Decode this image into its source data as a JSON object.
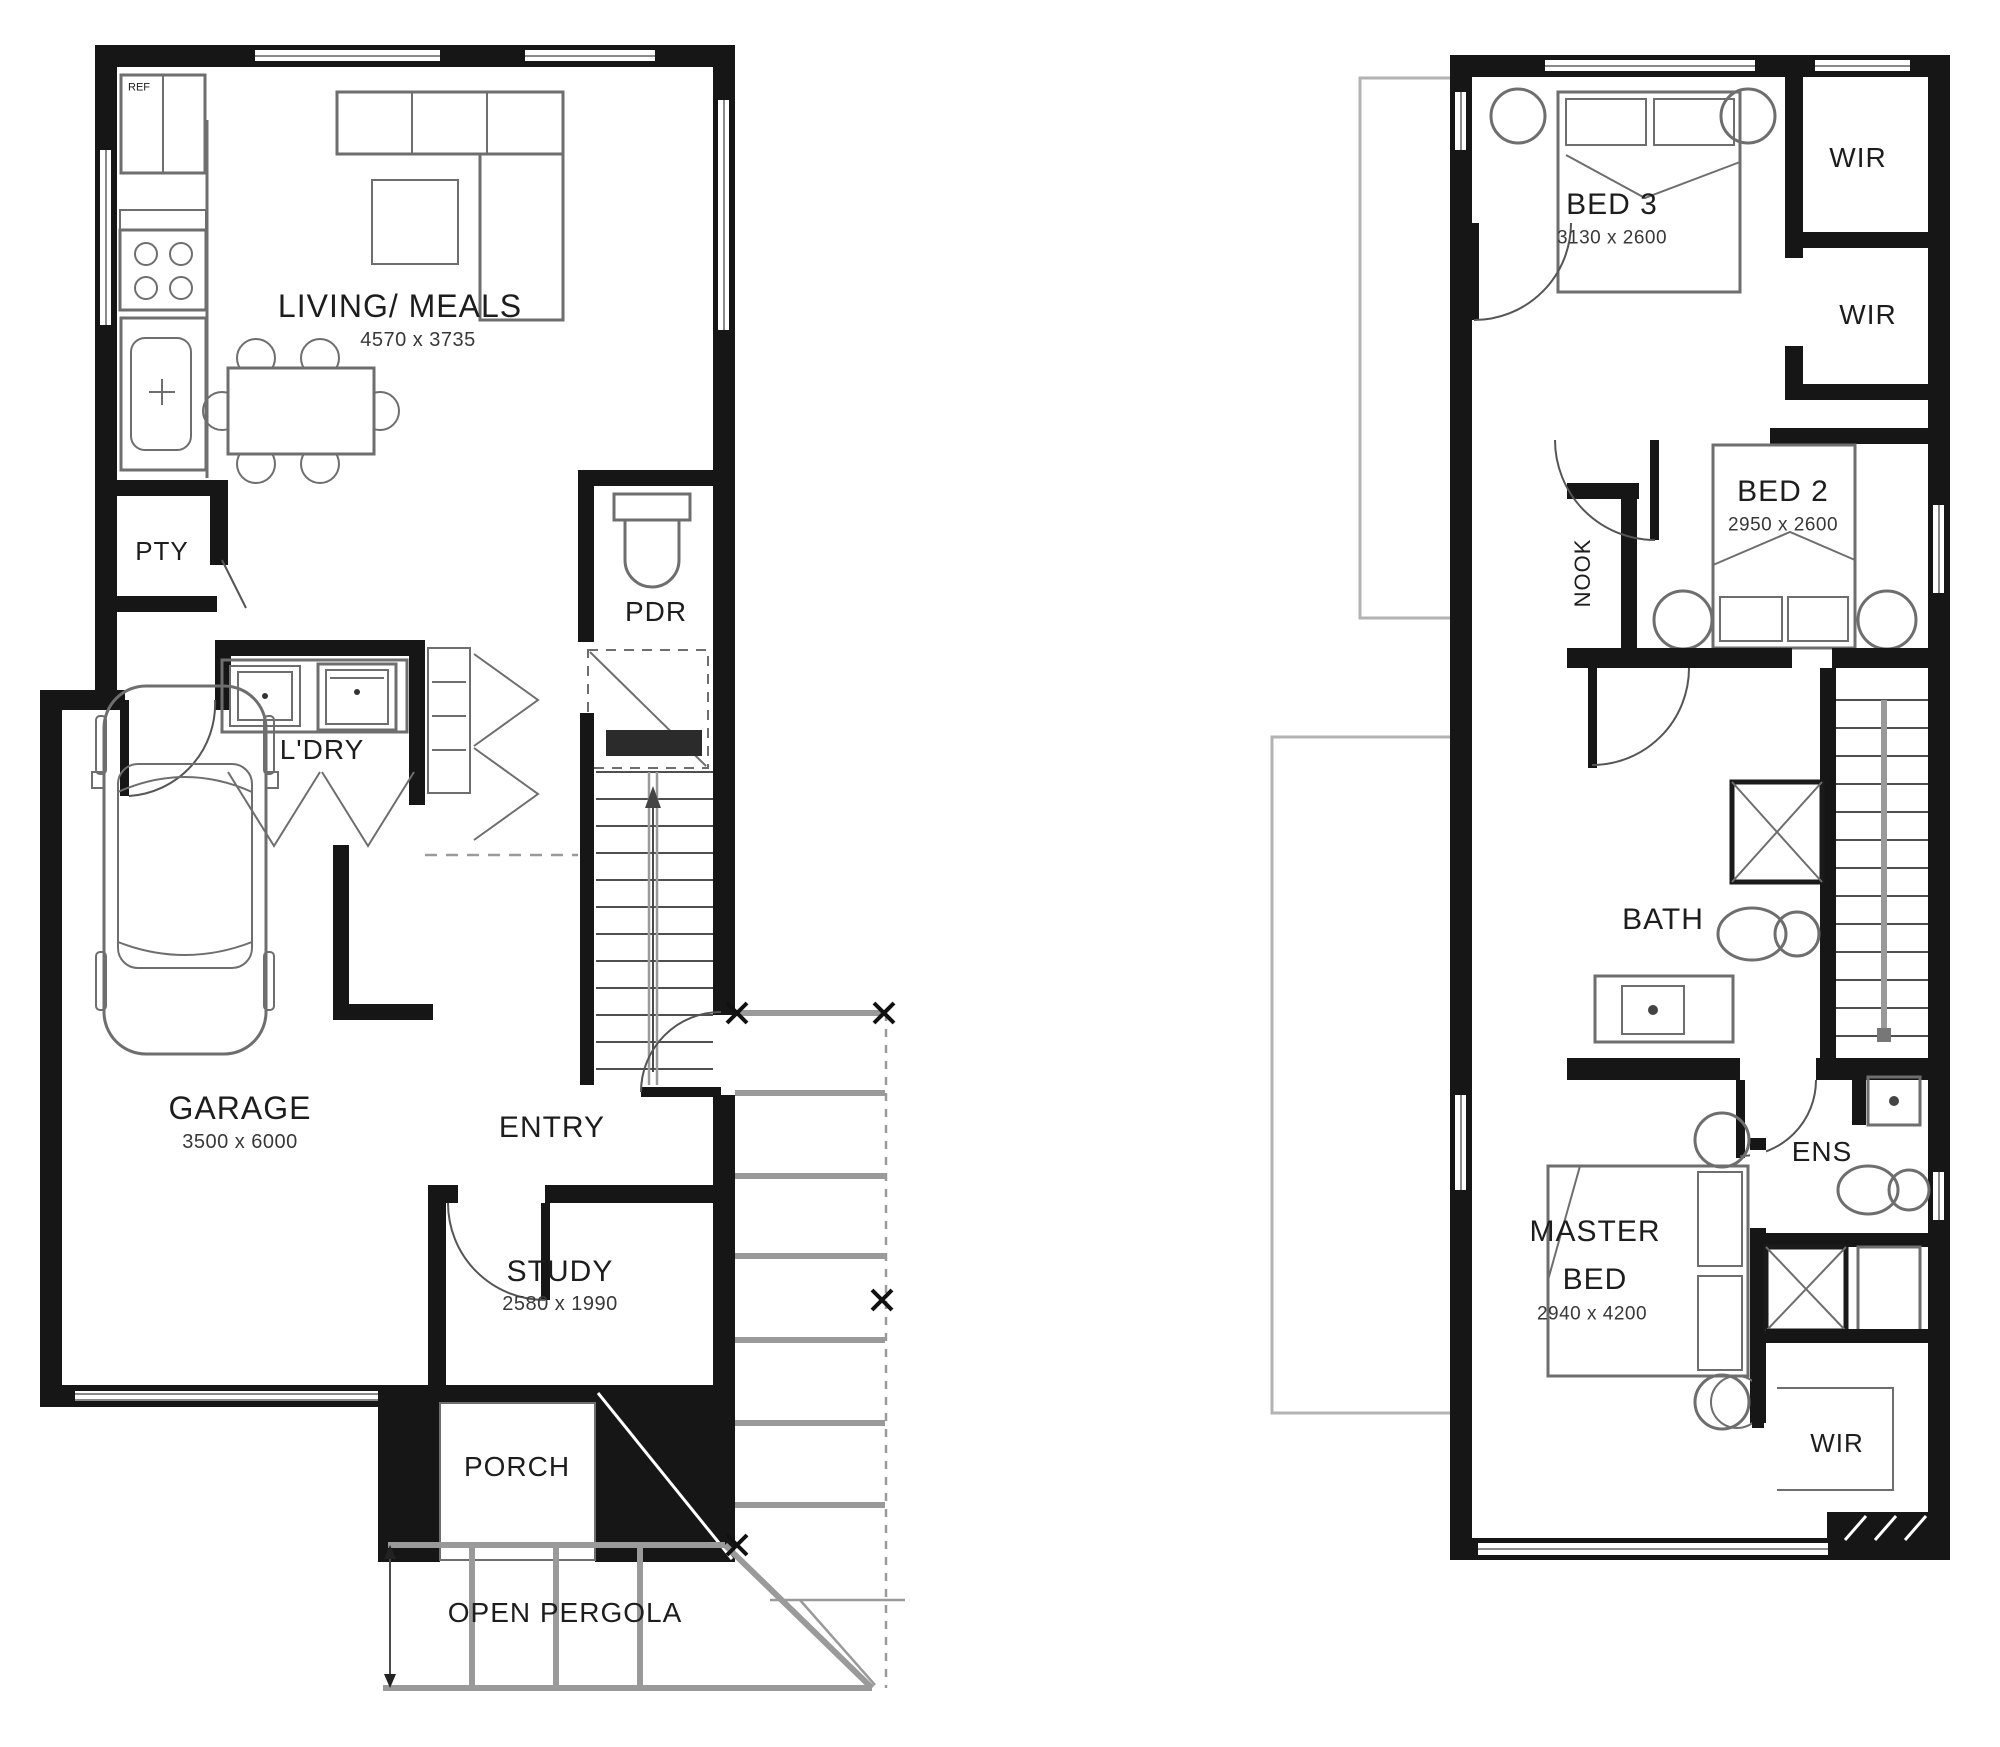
{
  "colors": {
    "background": "#ffffff",
    "wall": "#161616",
    "furniture_stroke": "#6e6e6e",
    "pergola_stroke": "#9a9a9a",
    "void_outline": "#b3b3b3"
  },
  "ground_floor": {
    "ref": {
      "label": "REF"
    },
    "living": {
      "label": "LIVING/ MEALS",
      "dims": "4570 x 3735"
    },
    "pty": {
      "label": "PTY"
    },
    "pdr": {
      "label": "PDR"
    },
    "ldry": {
      "label": "L'DRY"
    },
    "garage": {
      "label": "GARAGE",
      "dims": "3500 x 6000"
    },
    "entry": {
      "label": "ENTRY"
    },
    "study": {
      "label": "STUDY",
      "dims": "2580 x 1990"
    },
    "porch": {
      "label": "PORCH"
    },
    "pergola": {
      "label": "OPEN PERGOLA"
    }
  },
  "upper_floor": {
    "bed3": {
      "label": "BED 3",
      "dims": "3130 x 2600"
    },
    "wir_top": {
      "label": "WIR"
    },
    "wir_mid": {
      "label": "WIR"
    },
    "bed2": {
      "label": "BED 2",
      "dims": "2950 x 2600"
    },
    "nook": {
      "label": "NOOK"
    },
    "bath": {
      "label": "BATH"
    },
    "ens": {
      "label": "ENS"
    },
    "master": {
      "line1": "MASTER",
      "line2": "BED",
      "dims": "2940 x 4200"
    },
    "wir_bottom": {
      "label": "WIR"
    }
  }
}
